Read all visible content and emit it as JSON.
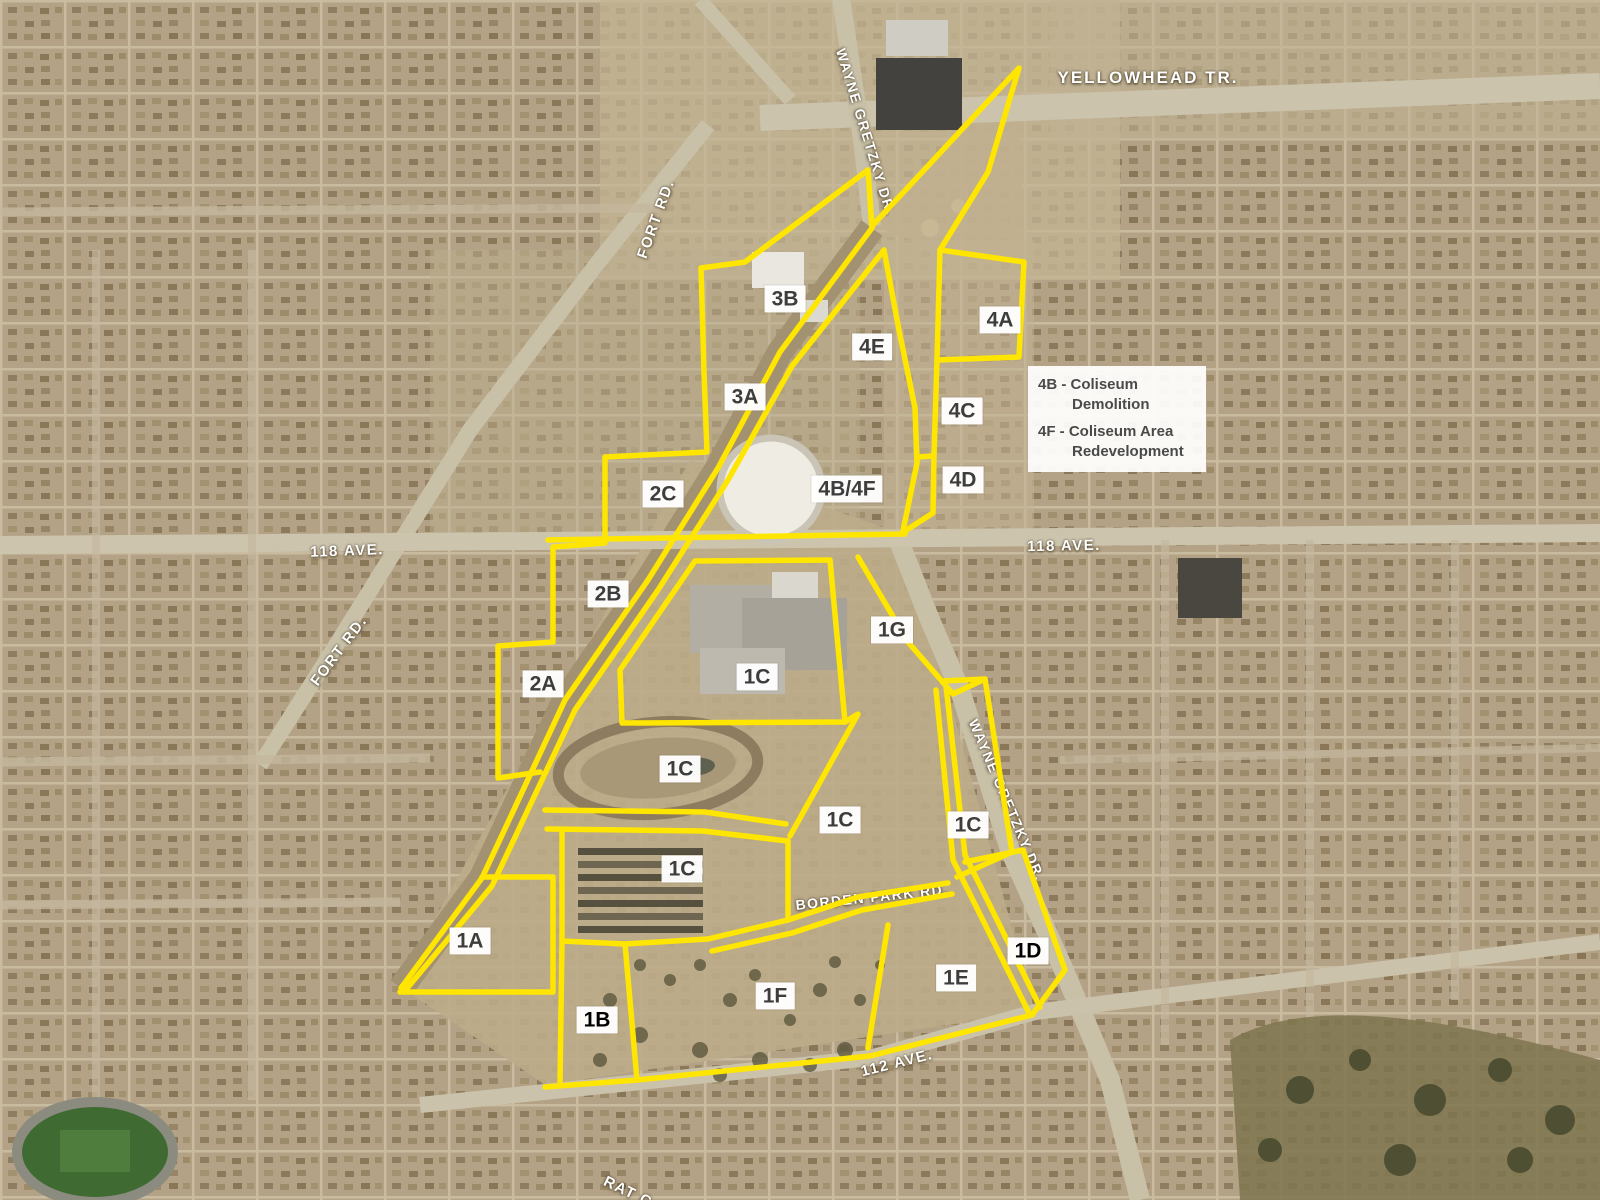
{
  "map_name": "Coliseum / Exhibition Lands redevelopment area aerial map",
  "colors": {
    "boundary": "#ffe600",
    "zone_label_text": "#3d3d3d",
    "street_label_text": "#ffffff",
    "legend_text": "#4a4a4a"
  },
  "legend": {
    "lines": [
      "4B - Coliseum",
      "Demolition",
      "4F - Coliseum Area",
      "Redevelopment"
    ]
  },
  "streets": {
    "yellowhead": "YELLOWHEAD TR.",
    "wayne_gretzky_top": "WAYNE GRETZKY DR.",
    "wayne_gretzky_south": "WAYNE GRETZKY DR.",
    "fort_rd_north": "FORT RD.",
    "fort_rd_south": "FORT RD.",
    "ave_118_west": "118 AVE.",
    "ave_118_east": "118 AVE.",
    "ave_112": "112 AVE.",
    "borden_park_rd": "BORDEN PARK RD.",
    "rat_creek": "RAT C"
  },
  "region_labels": [
    {
      "id": "3B",
      "label": "3B"
    },
    {
      "id": "3A",
      "label": "3A"
    },
    {
      "id": "4E",
      "label": "4E"
    },
    {
      "id": "4A",
      "label": "4A"
    },
    {
      "id": "4C",
      "label": "4C"
    },
    {
      "id": "4D",
      "label": "4D"
    },
    {
      "id": "4B4F",
      "label": "4B/4F"
    },
    {
      "id": "2C",
      "label": "2C"
    },
    {
      "id": "2B",
      "label": "2B"
    },
    {
      "id": "2A",
      "label": "2A"
    },
    {
      "id": "1G",
      "label": "1G"
    },
    {
      "id": "1C-mall",
      "label": "1C"
    },
    {
      "id": "1C-racetrack",
      "label": "1C"
    },
    {
      "id": "1C-center",
      "label": "1C"
    },
    {
      "id": "1C-east",
      "label": "1C"
    },
    {
      "id": "1C-barns",
      "label": "1C"
    },
    {
      "id": "1A",
      "label": "1A"
    },
    {
      "id": "1B",
      "label": "1B"
    },
    {
      "id": "1D",
      "label": "1D"
    },
    {
      "id": "1E",
      "label": "1E"
    },
    {
      "id": "1F",
      "label": "1F"
    }
  ]
}
